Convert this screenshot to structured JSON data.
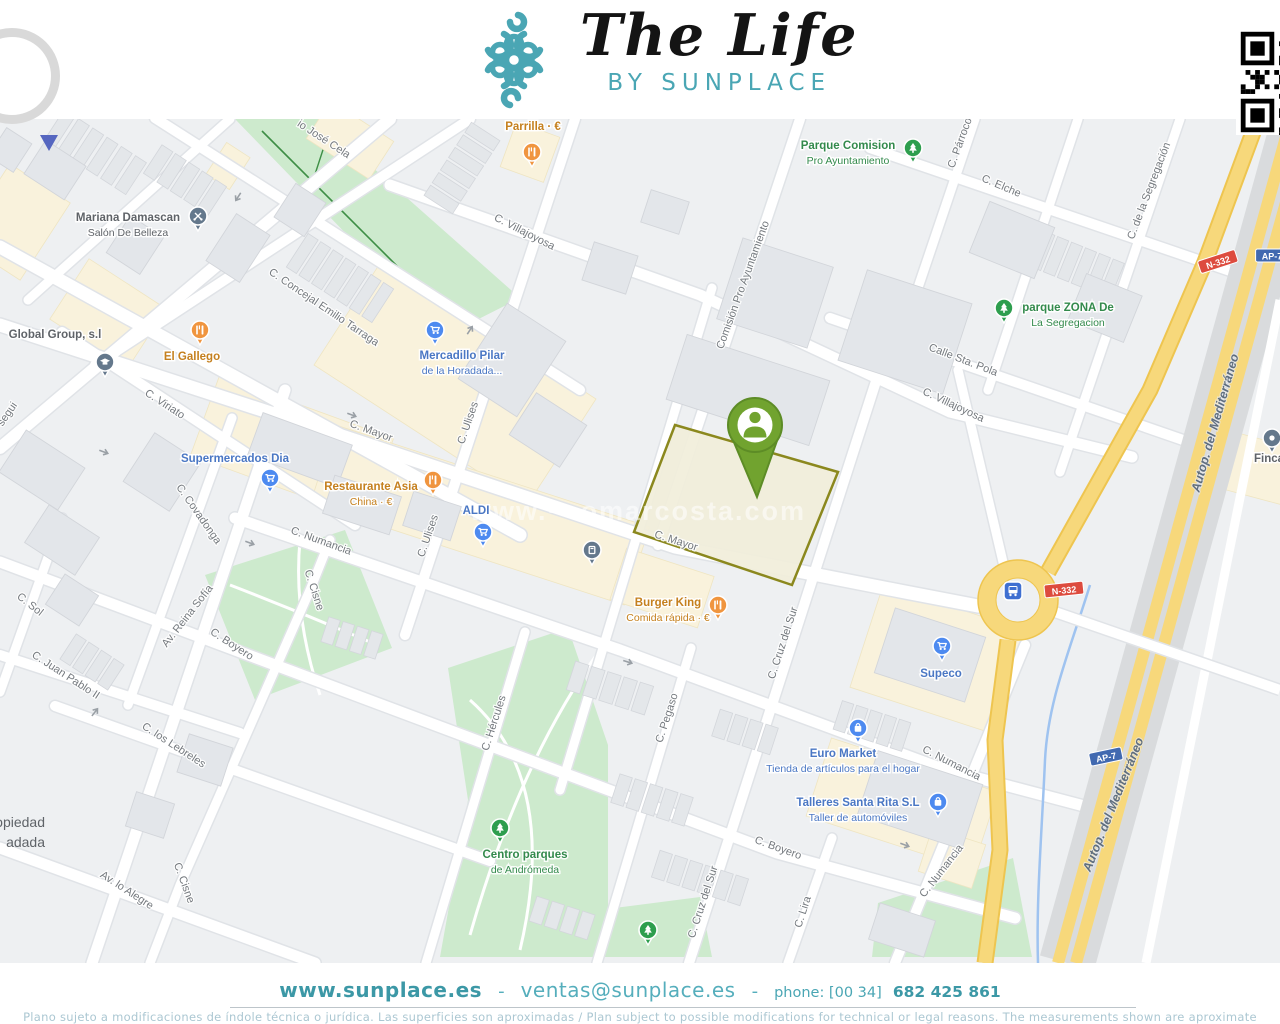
{
  "header": {
    "title": "The Life",
    "subtitle": "BY SUNPLACE",
    "logo_mark": "teal-knot-ornament",
    "qr_code": "qr-code-partially-cropped"
  },
  "brand_colors": {
    "teal": "#4aa6b4",
    "restaurant_orange": "#c5801e",
    "shop_blue": "#4a77c4",
    "park_green": "#338a4c",
    "plot_border_olive": "#8b881e",
    "marker_green": "#71a32f",
    "road_yellow": "#f7d87b",
    "badge_red": "#dd4b3e",
    "badge_blue": "#4169b0"
  },
  "map": {
    "watermark": "www.···omarcosta.com",
    "property_marker": {
      "label": "property-location-marker",
      "x": 755,
      "y": 425
    },
    "street_labels": [
      {
        "text": "io José Cela",
        "x": 322,
        "y": 142,
        "rot": 33
      },
      {
        "text": "C. Concejal Emilio Tarraga",
        "x": 322,
        "y": 310,
        "rot": 34
      },
      {
        "text": "C. Villajoyosa",
        "x": 523,
        "y": 235,
        "rot": 27
      },
      {
        "text": "C. Villajoyosa",
        "x": 952,
        "y": 408,
        "rot": 25
      },
      {
        "text": "Comisión Pro Ayuntamiento",
        "x": 746,
        "y": 286,
        "rot": -70
      },
      {
        "text": "C. Párroco",
        "x": 963,
        "y": 144,
        "rot": -70
      },
      {
        "text": "C. Elche",
        "x": 1000,
        "y": 189,
        "rot": 23
      },
      {
        "text": "C. de la Segregación",
        "x": 1152,
        "y": 192,
        "rot": -69
      },
      {
        "text": "Calle Sta. Pola",
        "x": 962,
        "y": 363,
        "rot": 21
      },
      {
        "text": "C. Mayor",
        "x": 370,
        "y": 434,
        "rot": 20
      },
      {
        "text": "C. Mayor",
        "x": 675,
        "y": 544,
        "rot": 18
      },
      {
        "text": "C. Ulises",
        "x": 471,
        "y": 424,
        "rot": -71
      },
      {
        "text": "C. Ulises",
        "x": 431,
        "y": 537,
        "rot": -71
      },
      {
        "text": "C. Viriato",
        "x": 163,
        "y": 407,
        "rot": 33
      },
      {
        "text": "C. Covadonga",
        "x": 196,
        "y": 516,
        "rot": 55
      },
      {
        "text": "C. Sol",
        "x": 28,
        "y": 607,
        "rot": 38
      },
      {
        "text": "Av. Reina Sofía",
        "x": 190,
        "y": 618,
        "rot": -52
      },
      {
        "text": "C. Numancia",
        "x": 320,
        "y": 544,
        "rot": 20
      },
      {
        "text": "C. Numancia",
        "x": 950,
        "y": 766,
        "rot": 27
      },
      {
        "text": "C. Numancia",
        "x": 944,
        "y": 873,
        "rot": -52
      },
      {
        "text": "C. Boyero",
        "x": 230,
        "y": 647,
        "rot": 33
      },
      {
        "text": "C. Boyero",
        "x": 777,
        "y": 851,
        "rot": 20
      },
      {
        "text": "C. Juan Pablo II",
        "x": 64,
        "y": 678,
        "rot": 33
      },
      {
        "text": "C. los Lebreles",
        "x": 172,
        "y": 748,
        "rot": 33
      },
      {
        "text": "Av. lo Alegre",
        "x": 125,
        "y": 893,
        "rot": 33
      },
      {
        "text": "C. Cisne",
        "x": 311,
        "y": 591,
        "rot": 72
      },
      {
        "text": "C. Cisne",
        "x": 181,
        "y": 884,
        "rot": 70
      },
      {
        "text": "C. Hércules",
        "x": 497,
        "y": 724,
        "rot": -72
      },
      {
        "text": "C. Pegaso",
        "x": 670,
        "y": 719,
        "rot": -72
      },
      {
        "text": "C. Cruz del Sur",
        "x": 786,
        "y": 644,
        "rot": -72
      },
      {
        "text": "C. Cruz del Sur",
        "x": 706,
        "y": 903,
        "rot": -72
      },
      {
        "text": "C. Lira",
        "x": 806,
        "y": 913,
        "rot": -72
      },
      {
        "text": "segui",
        "x": 10,
        "y": 416,
        "rot": -55
      },
      {
        "text": "Autop. del Mediterráneo",
        "x": 1219,
        "y": 424,
        "rot": -74,
        "cls": "motorway-label"
      },
      {
        "text": "Autop. del Mediterráneo",
        "x": 1117,
        "y": 806,
        "rot": -68,
        "cls": "motorway-label"
      }
    ],
    "pois": [
      {
        "name": "parrilla",
        "type": "restaurant",
        "glyph": "fork-knife",
        "lines": [
          "Parrilla · €"
        ],
        "label": {
          "x": 533,
          "y": 130
        },
        "pin": {
          "x": 532,
          "y": 152
        }
      },
      {
        "name": "el-gallego",
        "type": "restaurant",
        "glyph": "fork-knife",
        "lines": [
          "El Gallego"
        ],
        "label": {
          "x": 192,
          "y": 360
        },
        "pin": {
          "x": 200,
          "y": 330
        }
      },
      {
        "name": "restaurante-asia",
        "type": "restaurant",
        "glyph": "fork-knife",
        "lines": [
          "Restaurante Asia",
          "China · €"
        ],
        "label": {
          "x": 371,
          "y": 490
        },
        "pin": {
          "x": 433,
          "y": 480
        }
      },
      {
        "name": "burger-king",
        "type": "restaurant",
        "glyph": "fork-knife",
        "lines": [
          "Burger King",
          "Comida rápida · €"
        ],
        "label": {
          "x": 668,
          "y": 606
        },
        "pin": {
          "x": 718,
          "y": 605
        }
      },
      {
        "name": "mercadillo",
        "type": "shop",
        "glyph": "cart",
        "lines": [
          "Mercadillo Pilar",
          "de la Horadada..."
        ],
        "label": {
          "x": 462,
          "y": 359
        },
        "pin": {
          "x": 435,
          "y": 330
        }
      },
      {
        "name": "supermercados-dia",
        "type": "shop",
        "glyph": "cart",
        "lines": [
          "Supermercados Dia"
        ],
        "label": {
          "x": 235,
          "y": 462
        },
        "pin": {
          "x": 270,
          "y": 478
        }
      },
      {
        "name": "aldi",
        "type": "shop",
        "glyph": "cart",
        "lines": [
          "ALDI"
        ],
        "label": {
          "x": 476,
          "y": 514
        },
        "pin": {
          "x": 483,
          "y": 532
        }
      },
      {
        "name": "supeco",
        "type": "shop",
        "glyph": "cart",
        "lines": [
          "Supeco"
        ],
        "label": {
          "x": 941,
          "y": 677
        },
        "pin": {
          "x": 942,
          "y": 646
        }
      },
      {
        "name": "euro-market",
        "type": "shop",
        "glyph": "bag",
        "lines": [
          "Euro Market",
          "Tienda de artículos para el hogar"
        ],
        "label": {
          "x": 843,
          "y": 757
        },
        "pin": {
          "x": 858,
          "y": 728
        }
      },
      {
        "name": "talleres-santa-rita",
        "type": "shop",
        "glyph": "bag",
        "lines": [
          "Talleres Santa Rita S.L",
          "Taller de automóviles"
        ],
        "label": {
          "x": 858,
          "y": 806
        },
        "pin": {
          "x": 938,
          "y": 802
        }
      },
      {
        "name": "parque-comision",
        "type": "park",
        "glyph": "tree",
        "lines": [
          "Parque Comision",
          "Pro Ayuntamiento"
        ],
        "label": {
          "x": 848,
          "y": 149
        },
        "pin": {
          "x": 913,
          "y": 148
        }
      },
      {
        "name": "parque-zona-segregacion",
        "type": "park",
        "glyph": "tree",
        "lines": [
          "parque ZONA De",
          "La Segregacion"
        ],
        "label": {
          "x": 1068,
          "y": 311
        },
        "pin": {
          "x": 1004,
          "y": 308
        }
      },
      {
        "name": "centro-parques-andromeda",
        "type": "park",
        "glyph": "tree",
        "lines": [
          "Centro parques",
          "de Andrómeda"
        ],
        "label": {
          "x": 525,
          "y": 858
        },
        "pin": {
          "x": 500,
          "y": 828
        }
      },
      {
        "name": "small-park-pin",
        "type": "park",
        "glyph": "tree",
        "lines": [],
        "label": {
          "x": 648,
          "y": 955
        },
        "pin": {
          "x": 648,
          "y": 930
        }
      },
      {
        "name": "mariana-damascan",
        "type": "gray",
        "glyph": "scissors",
        "lines": [
          "Mariana Damascan",
          "Salón De Belleza"
        ],
        "label": {
          "x": 128,
          "y": 221
        },
        "pin": {
          "x": 198,
          "y": 216
        }
      },
      {
        "name": "global-group",
        "type": "gray",
        "glyph": "",
        "lines": [
          "Global Group, s.l"
        ],
        "label": {
          "x": 55,
          "y": 338
        }
      },
      {
        "name": "school-pin",
        "type": "gray",
        "glyph": "grad-cap",
        "lines": [],
        "label": {
          "x": 105,
          "y": 400
        },
        "pin": {
          "x": 105,
          "y": 362
        }
      },
      {
        "name": "ev-station-pin",
        "type": "gray",
        "glyph": "pump",
        "lines": [],
        "label": {
          "x": 592,
          "y": 585
        },
        "pin": {
          "x": 592,
          "y": 550
        }
      },
      {
        "name": "finca",
        "type": "gray",
        "glyph": "dot",
        "lines": [
          "Finca"
        ],
        "label": {
          "x": 1254,
          "y": 462,
          "anchor": "start"
        },
        "pin": {
          "x": 1272,
          "y": 438
        }
      },
      {
        "name": "cropped-gray-label",
        "type": "graybig",
        "glyph": "",
        "lines": [
          "opiedad",
          "adada"
        ],
        "label": {
          "x": 45,
          "y": 827,
          "anchor": "end",
          "lh": 20
        }
      }
    ],
    "road_badges": [
      {
        "text": "N-332",
        "type": "red",
        "x": 1218,
        "y": 262,
        "rot": -18
      },
      {
        "text": "N-332",
        "type": "red",
        "x": 1064,
        "y": 590,
        "rot": -6
      },
      {
        "text": "AP-7",
        "type": "blue",
        "x": 1272,
        "y": 256,
        "rot": 0
      },
      {
        "text": "AP-7",
        "type": "blue",
        "x": 1106,
        "y": 757,
        "rot": -12
      }
    ],
    "transit": {
      "bus_stop_icon": "bus-stop-badge",
      "x": 1013,
      "y": 591
    }
  },
  "footer": {
    "website": "www.sunplace.es",
    "separator": "-",
    "email": "ventas@sunplace.es",
    "phone_label": "phone: [00 34]",
    "phone_number": "682 425 861",
    "disclaimer": "Plano sujeto a modificaciones de índole técnica o jurídica. Las superficies son aproximadas / Plan subject to possible modifications for technical or legal reasons. The measurements  shown are aproximate"
  }
}
